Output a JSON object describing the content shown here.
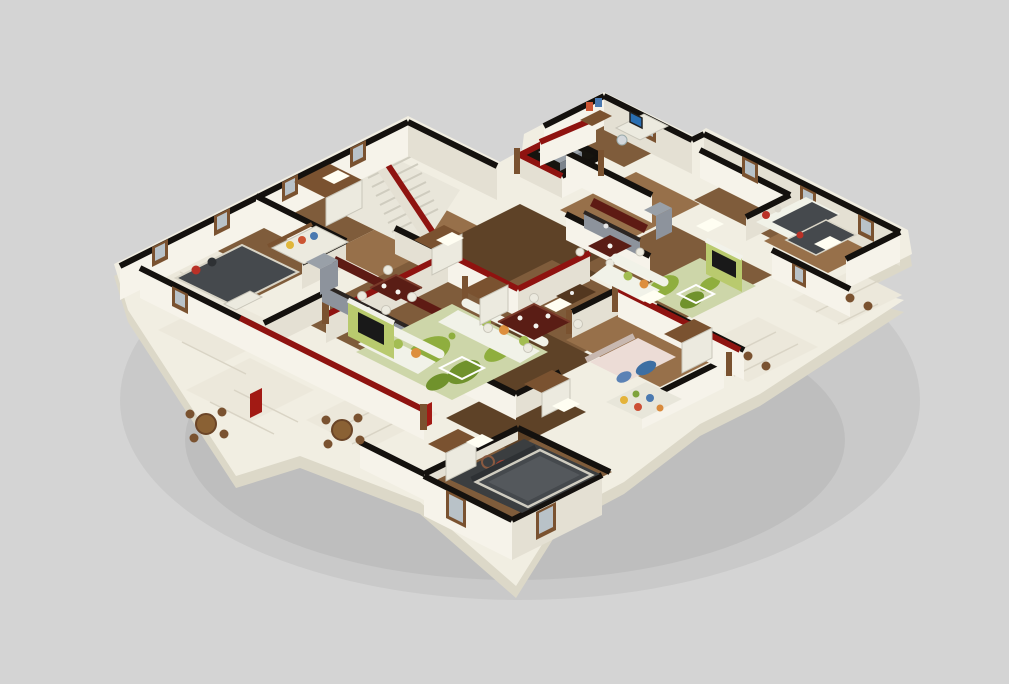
{
  "scene": {
    "type": "3d-isometric-floor-plan-render",
    "description": "Isometric 3D cutaway rendering of one residential floor with four furnished apartment units arranged around a central staircase and elevator core, on a plain light-gray background",
    "projection": "isometric-cutaway",
    "core": [
      "staircase",
      "elevator-shaft",
      "entry-corridor"
    ],
    "units": [
      {
        "name": "northwest-apartment",
        "rooms": [
          "bedroom",
          "kids-room",
          "kitchen-dining",
          "living-room",
          "balcony"
        ]
      },
      {
        "name": "northeast-apartment",
        "rooms": [
          "study-room",
          "kitchen",
          "living-room",
          "bedroom",
          "side-balcony"
        ]
      },
      {
        "name": "east-apartment",
        "rooms": [
          "bedroom",
          "balcony"
        ]
      },
      {
        "name": "south-apartment",
        "rooms": [
          "dining-room",
          "kids-bedroom",
          "hall",
          "master-bedroom",
          "balconies"
        ]
      }
    ],
    "furniture": [
      "beds",
      "sofas-with-floral-cushions",
      "green-leaf-rugs",
      "dining-tables-with-white-chairs",
      "kitchen-counters",
      "tv-wall-panels",
      "wardrobes",
      "round-balcony-tables",
      "computer-desk"
    ]
  },
  "colors": {
    "bg": "#d4d4d4",
    "right-margin": "#ffffff",
    "slab": "#f1eee2",
    "slab-edge": "#dcd8c8",
    "wall": "#f6f3ea",
    "wall-shade": "#e4e0d3",
    "wall-top-black": "#14110e",
    "wall-top-red": "#8f1310",
    "wall-face-red": "#a21a14",
    "wood": "#7f5c3b",
    "wood-dark": "#5e4227",
    "wood-light": "#97704a",
    "tile": "#ece8db",
    "tile-line": "#d9d4c5",
    "rug": "#cdd6a9",
    "rug-leaf": "#8fae3e",
    "rug-leaf-dark": "#70922c",
    "sofa": "#f1f2e8",
    "cushion-green": "#a3bd52",
    "cushion-orange": "#dd8f3e",
    "table-redwood": "#5a1d15",
    "chair-white": "#eceadf",
    "bed-charcoal": "#45494d",
    "bed-charcoal-dark": "#2e3134",
    "pillow-red": "#b93127",
    "bed-pink": "#ecdcd6",
    "fabric-blue": "#3e6fa3",
    "counter-gray": "#8d939c",
    "fridge-gray": "#99a0a8",
    "cabinet-red": "#5e1b14",
    "counter-top": "#2b2522",
    "frame-wood": "#7a5230",
    "frame-dark": "#53371f",
    "glass": "#b9c2c8",
    "tv-panel-green": "#b9ca6e",
    "tv-screen": "#191919",
    "stair-floor": "#e9e6da",
    "stair-line": "#cfccbf",
    "elevator-dark": "#16140f",
    "elevator-cab": "#9aa1a9",
    "ceiling-light": "#fffef2",
    "monitor-blue": "#2a6fb3"
  }
}
